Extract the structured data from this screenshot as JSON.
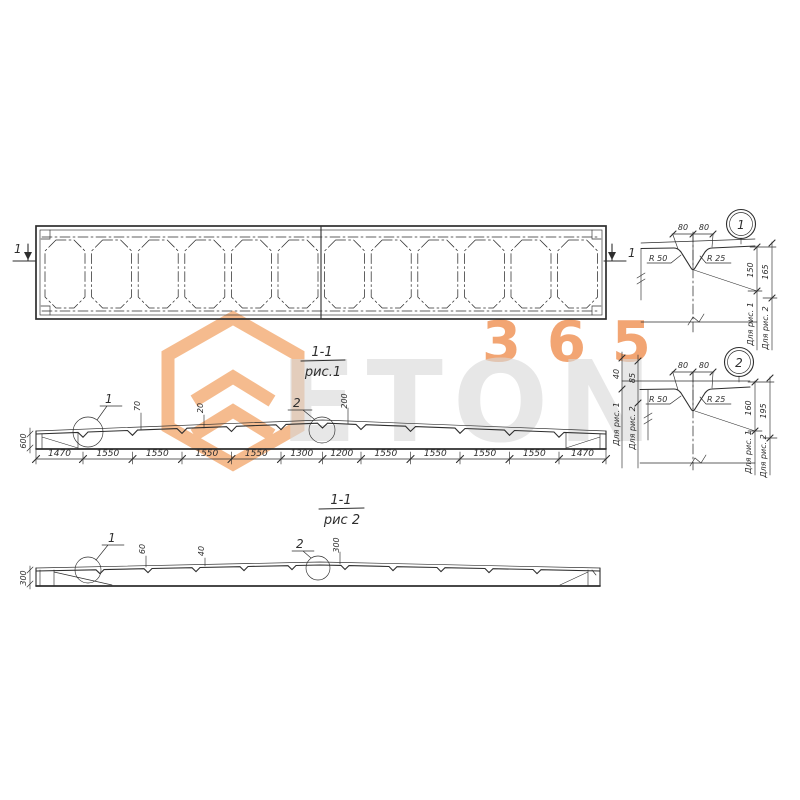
{
  "palette": {
    "line": "#2e2e2e",
    "accent_orange": "#ef8d4d",
    "logo_orange": "#f2a263",
    "brand_gray": "#d9d9d9"
  },
  "watermark": {
    "number": "365",
    "brand": "ETON"
  },
  "plan": {
    "marker_left": "1",
    "marker_right": "1"
  },
  "fig1": {
    "title": "1-1",
    "subtitle": "рис.1",
    "callout1": "1",
    "callout2": "2",
    "height_left": "600",
    "groove_dims": [
      "70",
      "20",
      "200"
    ],
    "dims": [
      "1470",
      "1550",
      "1550",
      "1550",
      "1550",
      "1300",
      "1200",
      "1550",
      "1550",
      "1550",
      "1550",
      "1470"
    ]
  },
  "fig2": {
    "title": "1-1",
    "subtitle": "рис 2",
    "callout1": "1",
    "callout2": "2",
    "height_left": "300",
    "groove_dims": [
      "60",
      "40",
      "300"
    ]
  },
  "detail1": {
    "number": "1",
    "top_dims": [
      "80",
      "80"
    ],
    "radius_left": "R 50",
    "radius_right": "R 25",
    "side_dims": [
      {
        "value": "150",
        "label": "Для рис. 1"
      },
      {
        "value": "165",
        "label": "Для рис. 2"
      }
    ]
  },
  "detail2": {
    "number": "2",
    "top_dims": [
      "80",
      "80"
    ],
    "radius_left": "R 50",
    "radius_right": "R 25",
    "left_dims": [
      {
        "value": "40",
        "label": "Для рис. 1"
      },
      {
        "value": "85",
        "label": "Для рис. 2"
      }
    ],
    "side_dims": [
      {
        "value": "160",
        "label": "Для рис. 1"
      },
      {
        "value": "195",
        "label": "Для рис. 2"
      }
    ]
  }
}
